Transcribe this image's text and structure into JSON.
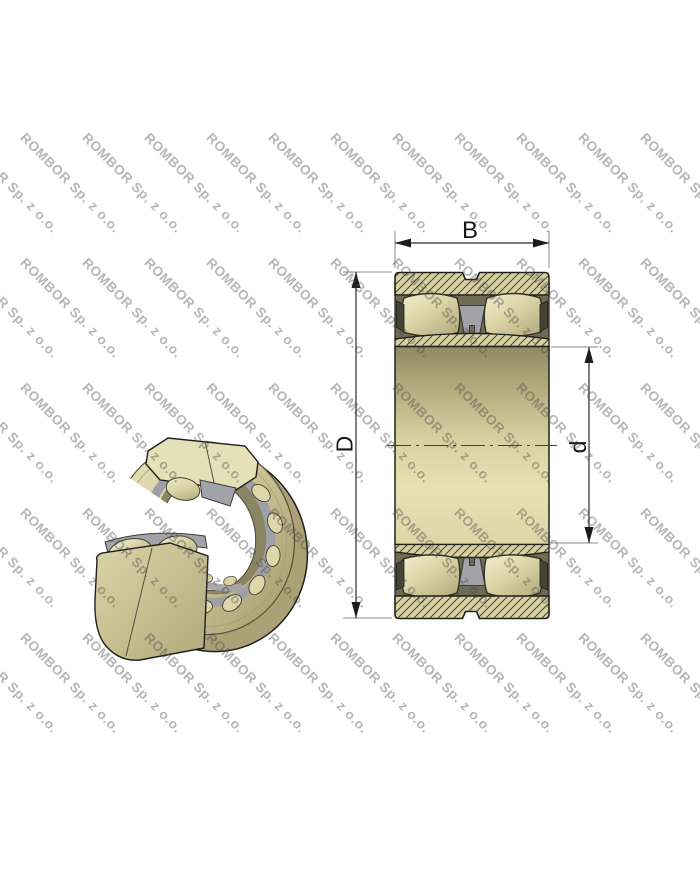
{
  "watermark": {
    "text": "ROMBOR Sp. z o.o.",
    "angle_deg": 45,
    "color": "rgba(72,72,72,0.40)",
    "font_size_px": 13.5,
    "columns_x": [
      -34,
      28,
      90,
      152,
      214,
      276,
      338,
      400,
      462,
      524,
      586,
      648
    ],
    "rows_y": [
      130,
      255,
      380,
      505,
      630
    ]
  },
  "drawing": {
    "labels": {
      "width": "B",
      "outer_diameter": "D",
      "bore_diameter": "d"
    },
    "colors": {
      "steel_tan": "#d7d0a1",
      "steel_light": "#f2ecd2",
      "steel_dark": "#a99f72",
      "hatch_line": "#4c4937",
      "cavity": "#6e6a54",
      "cage_gray": "#a2a3a8",
      "outline": "#20201c",
      "dimension_line": "#2b2b2b",
      "extension_line": "#8a8a8a",
      "background": "#ffffff"
    }
  }
}
